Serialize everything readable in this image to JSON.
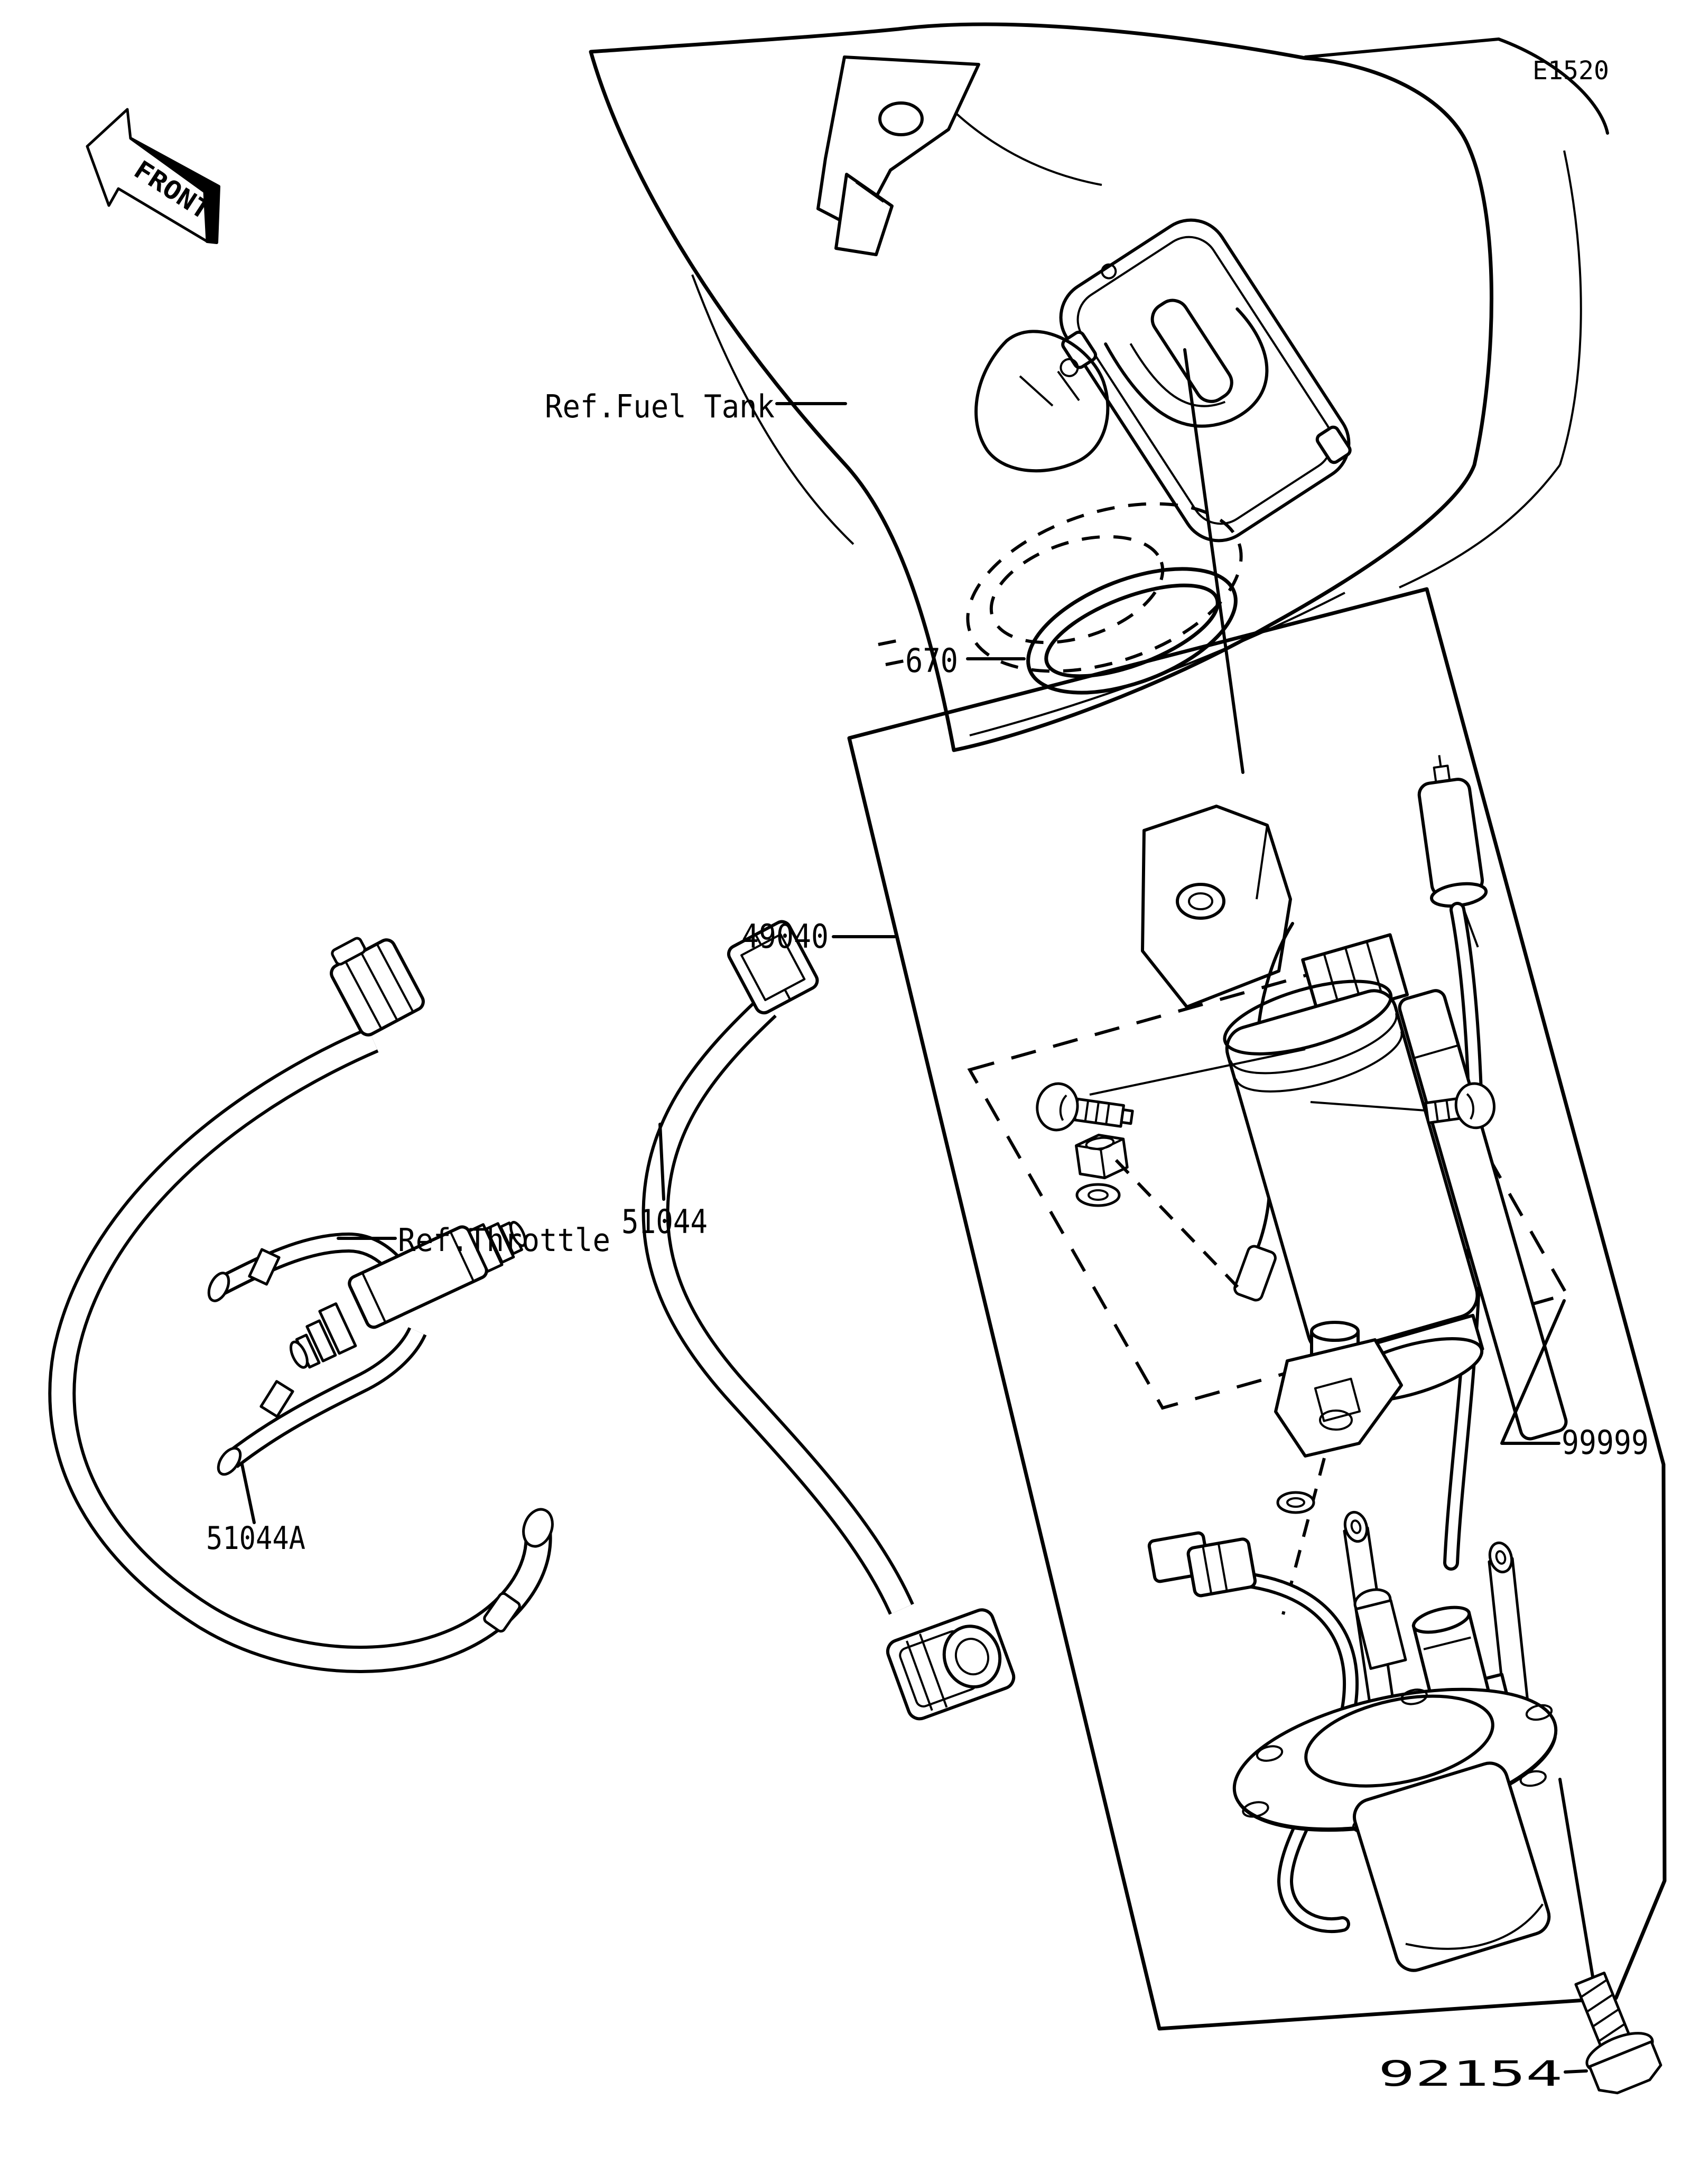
{
  "colors": {
    "background": "#ffffff",
    "line": "#000000"
  },
  "diagram_code": "E1520",
  "front_arrow_label": "FRONT",
  "ref_labels": {
    "fuel_tank": "Ref.Fuel Tank",
    "throttle": "Ref.Throttle"
  },
  "part_numbers": {
    "o_ring": "670",
    "fuel_pump": "49040",
    "fuel_hose": "51044",
    "fuel_hose_a": "51044A",
    "accessory_kit": "99999",
    "bolt": "92154"
  }
}
